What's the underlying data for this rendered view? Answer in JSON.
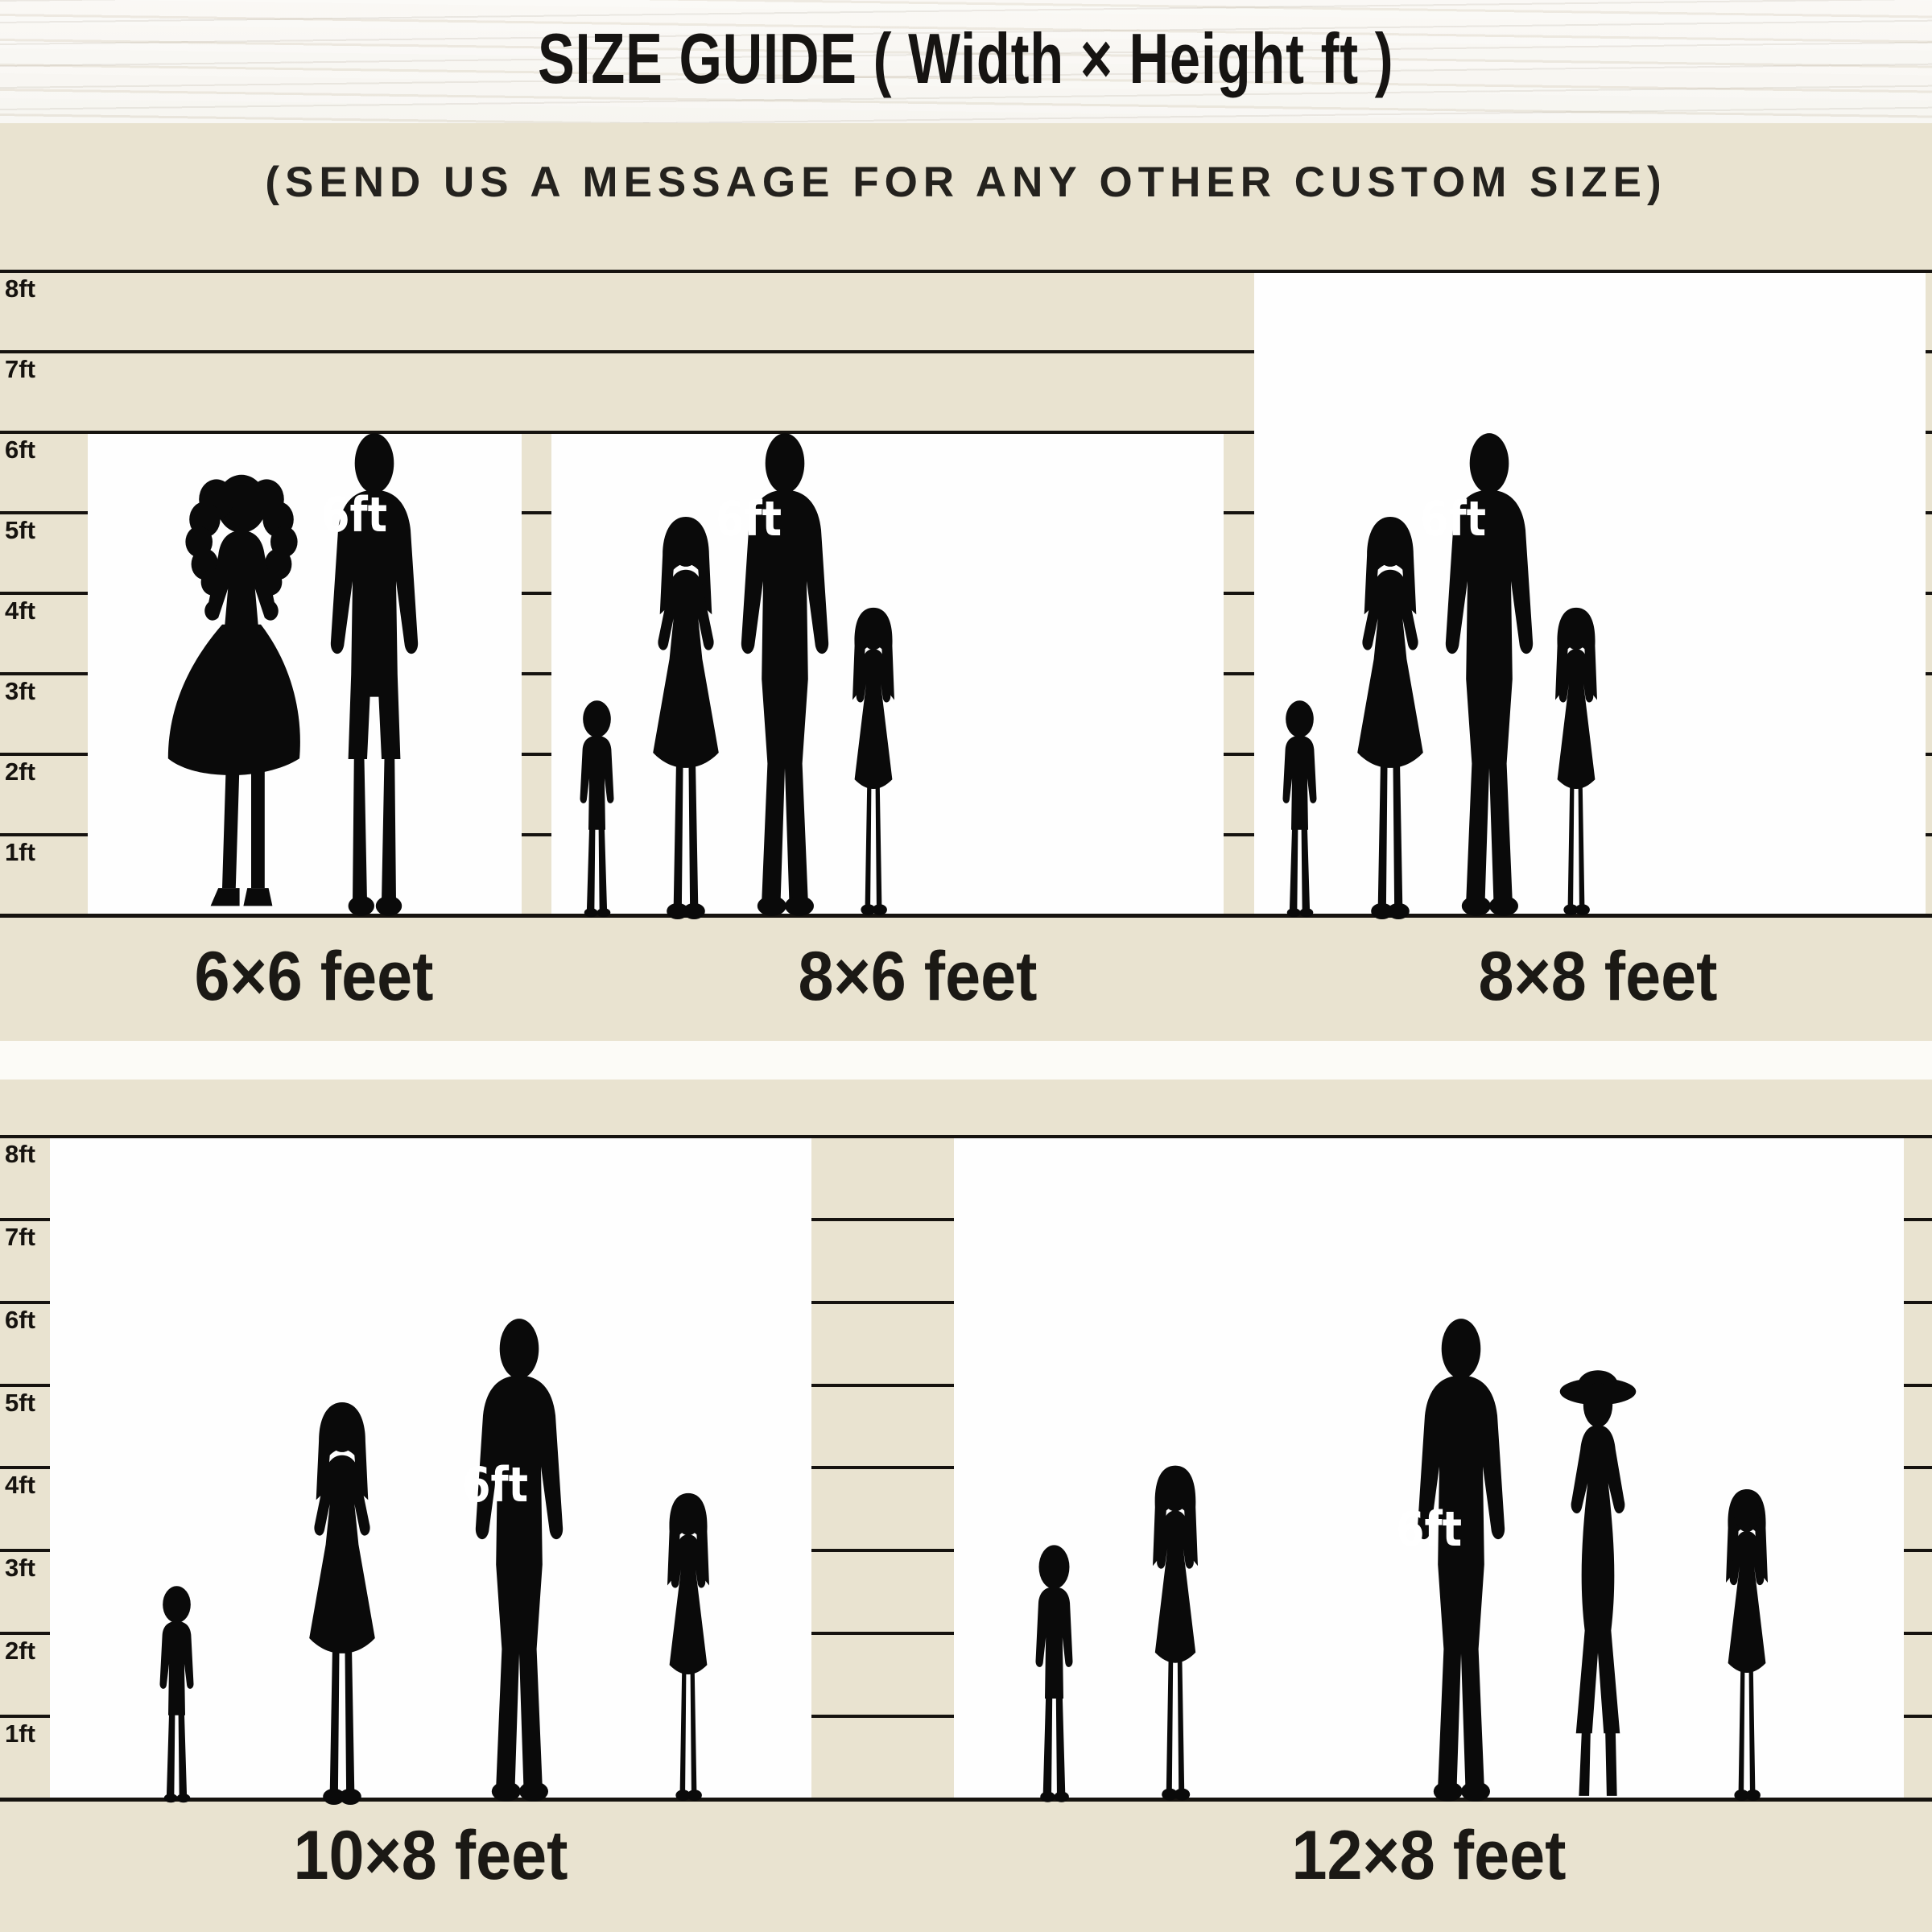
{
  "header": {
    "title": "SIZE GUIDE ( Width × Height ft )"
  },
  "subtitle": "(SEND US A MESSAGE FOR ANY OTHER CUSTOM SIZE)",
  "ruler": {
    "labels": [
      "8ft",
      "7ft",
      "6ft",
      "5ft",
      "4ft",
      "3ft",
      "2ft",
      "1ft"
    ]
  },
  "reference_height_label": "6ft",
  "sizes": [
    {
      "label": "6×6 feet",
      "width_ft": 6,
      "height_ft": 6,
      "people": [
        "woman",
        "man"
      ]
    },
    {
      "label": "8×6 feet",
      "width_ft": 8,
      "height_ft": 6,
      "people": [
        "boy",
        "woman",
        "man",
        "girl"
      ]
    },
    {
      "label": "8×8 feet",
      "width_ft": 8,
      "height_ft": 8,
      "people": [
        "boy",
        "woman",
        "man",
        "girl"
      ]
    },
    {
      "label": "10×8 feet",
      "width_ft": 10,
      "height_ft": 8,
      "people": [
        "boy",
        "woman",
        "man",
        "girl"
      ]
    },
    {
      "label": "12×8 feet",
      "width_ft": 12,
      "height_ft": 8,
      "people": [
        "boy",
        "girl",
        "man",
        "woman-hat",
        "girl"
      ]
    }
  ],
  "colors": {
    "background": "#e9e3d0",
    "box": "#fefefe",
    "line": "#16130f",
    "silhouette": "#0a0a0a",
    "text": "#1b1915",
    "reference_label": "#ffffff",
    "wood_base": "#f4f1ea",
    "divider": "#fcfbf7"
  }
}
